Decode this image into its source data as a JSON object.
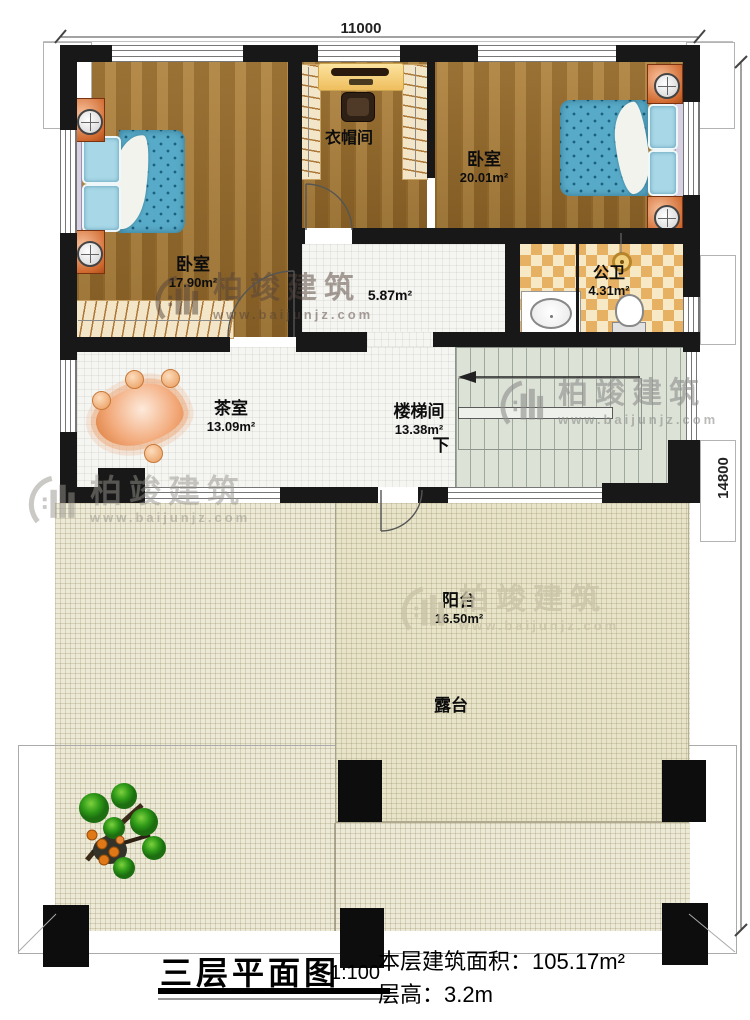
{
  "plan": {
    "rooms": {
      "bedroom_left": {
        "name": "卧室",
        "area": "17.90m²"
      },
      "cloakroom": {
        "name": "衣帽间"
      },
      "bedroom_right": {
        "name": "卧室",
        "area": "20.01m²"
      },
      "bathroom": {
        "name": "公卫",
        "area": "4.31m²"
      },
      "hallway": {
        "area": "5.87m²"
      },
      "tea_room": {
        "name": "茶室",
        "area": "13.09m²"
      },
      "stairwell": {
        "name": "楼梯间",
        "area": "13.38m²"
      },
      "balcony": {
        "name": "阳台",
        "area": "16.50m²"
      },
      "terrace": {
        "name": "露台"
      }
    },
    "stairs_down_label": "下",
    "dimensions": {
      "top": "11000",
      "right": "14800"
    }
  },
  "title_block": {
    "title": "三层平面图",
    "scale": "1:100",
    "floor_area": "本层建筑面积：105.17m²",
    "floor_height": "层高：3.2m"
  },
  "watermark": {
    "brand": "柏竣建筑",
    "url": "www.baijunjz.com"
  },
  "colors": {
    "wall": "#181818",
    "wood": "#a2742f",
    "checker_tile": "#e6b163",
    "stair": "#dce2d6",
    "terrace": "#ece9d6",
    "balcony": "#e8e4c9",
    "bed": "#58abc8",
    "accent_furniture": "#d06a30"
  }
}
